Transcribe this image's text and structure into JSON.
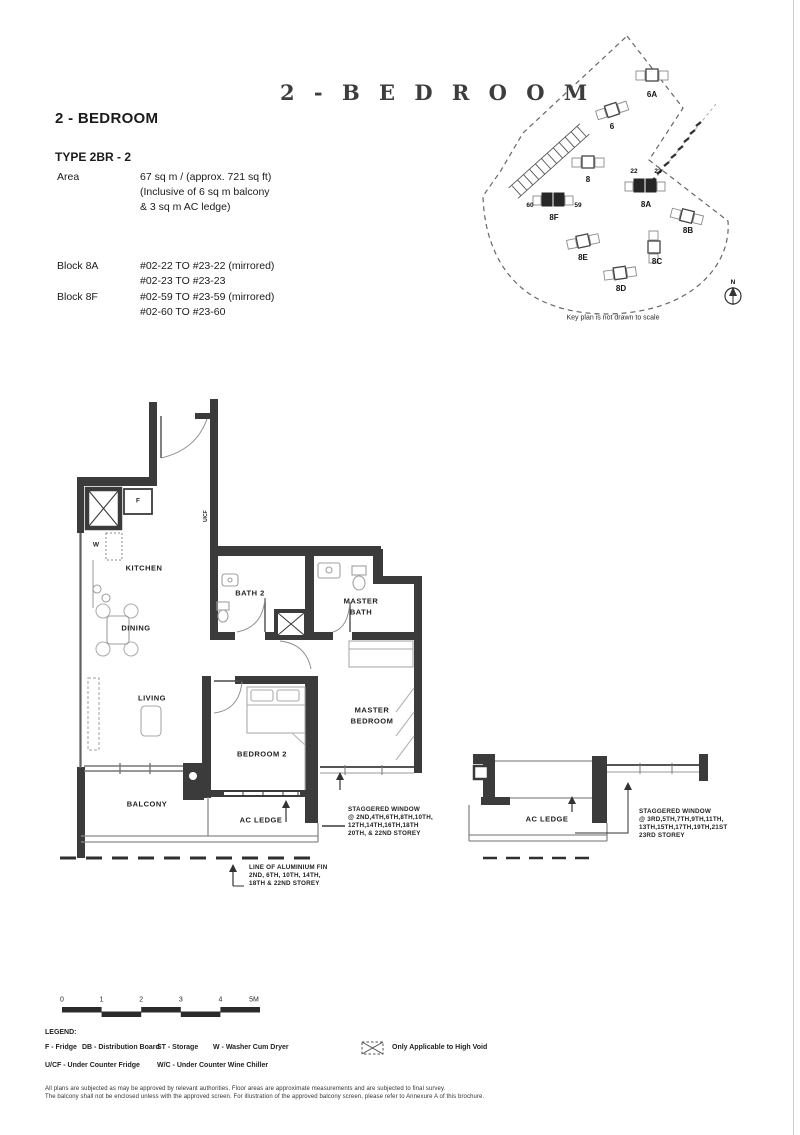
{
  "header": {
    "display_title": "2 - B E D R O O M",
    "section_title": "2 - BEDROOM",
    "type_label": "TYPE 2BR - 2"
  },
  "area": {
    "label": "Area",
    "lines": [
      "67 sq m / (approx. 721 sq ft)",
      "(Inclusive of 6 sq m balcony",
      "& 3 sq m AC ledge)"
    ]
  },
  "blocks": [
    {
      "name": "Block 8A",
      "units": [
        "#02-22 TO #23-22 (mirrored)",
        "#02-23 TO #23-23"
      ]
    },
    {
      "name": "Block 8F",
      "units": [
        "#02-59 TO #23-59 (mirrored)",
        "#02-60 TO #23-60"
      ]
    }
  ],
  "keyplan": {
    "caption": "Key plan is not drawn to scale",
    "north_label": "N",
    "buildings": [
      {
        "id": "6A"
      },
      {
        "id": "6"
      },
      {
        "id": "8"
      },
      {
        "id": "8A"
      },
      {
        "id": "8F"
      },
      {
        "id": "8B"
      },
      {
        "id": "8E"
      },
      {
        "id": "8C"
      },
      {
        "id": "8D"
      }
    ],
    "unit_labels": {
      "left_8a": "22",
      "right_8a": "23",
      "left_8f": "60",
      "right_8f": "59"
    }
  },
  "plan": {
    "rooms": {
      "kitchen": "KITCHEN",
      "dining": "DINING",
      "living": "LIVING",
      "balcony": "BALCONY",
      "bedroom2": "BEDROOM 2",
      "master_bedroom_l1": "MASTER",
      "master_bedroom_l2": "BEDROOM",
      "master_bath_l1": "MASTER",
      "master_bath_l2": "BATH",
      "bath2": "BATH 2",
      "ac_ledge": "AC LEDGE"
    },
    "fixtures": {
      "fridge": "F",
      "washer": "W",
      "ucf": "U/CF"
    },
    "detail": {
      "ac_ledge": "AC LEDGE"
    }
  },
  "annotations": {
    "staggered_low": [
      "STAGGERED WINDOW",
      "@ 2ND,4TH,6TH,8TH,10TH,",
      "12TH,14TH,16TH,18TH",
      "20TH, & 22ND STOREY"
    ],
    "staggered_high": [
      "STAGGERED WINDOW",
      "@ 3RD,5TH,7TH,9TH,11TH,",
      "13TH,15TH,17TH,19TH,21ST",
      "23RD STOREY"
    ],
    "alum_fin": [
      "LINE OF ALUMINIUM FIN",
      "2ND, 6TH, 10TH, 14TH,",
      "18TH & 22ND STOREY"
    ]
  },
  "scalebar": {
    "ticks": [
      "0",
      "1",
      "2",
      "3",
      "4",
      "5M"
    ]
  },
  "legend": {
    "title": "LEGEND:",
    "row1": [
      "F - Fridge",
      "DB - Distribution Board",
      "ST - Storage",
      "W - Washer Cum Dryer"
    ],
    "high_void": "Only Applicable to High Void",
    "row2": [
      "U/CF - Under Counter Fridge",
      "W/C - Under Counter Wine Chiller"
    ]
  },
  "disclaimer": [
    "All plans are subjected as may be approved by relevant authorities. Floor areas are approximate measurements and are subjected to final survey.",
    "The balcony shall not be enclosed unless with the approved screen. For illustration of the approved balcony screen, please refer to Annexure A of this brochure."
  ]
}
